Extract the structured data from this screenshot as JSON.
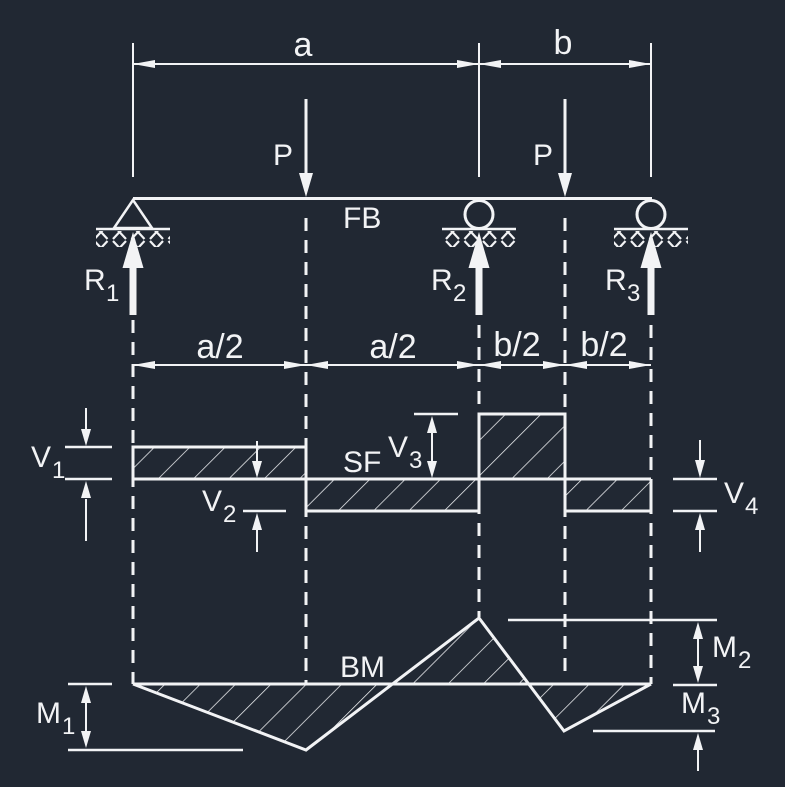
{
  "colors": {
    "background": "#212833",
    "stroke": "#f2f3f5"
  },
  "top_dims": {
    "a": "a",
    "b": "b"
  },
  "loads": {
    "p1": "P",
    "p2": "P"
  },
  "beam": {
    "label": "FB"
  },
  "reactions": {
    "r1": {
      "main": "R",
      "sub": "1"
    },
    "r2": {
      "main": "R",
      "sub": "2"
    },
    "r3": {
      "main": "R",
      "sub": "3"
    }
  },
  "half_dims": {
    "s1": "a/2",
    "s2": "a/2",
    "s3": "b/2",
    "s4": "b/2"
  },
  "shear": {
    "label": "SF",
    "v1": {
      "main": "V",
      "sub": "1"
    },
    "v2": {
      "main": "V",
      "sub": "2"
    },
    "v3": {
      "main": "V",
      "sub": "3"
    },
    "v4": {
      "main": "V",
      "sub": "4"
    }
  },
  "moment": {
    "label": "BM",
    "m1": {
      "main": "M",
      "sub": "1"
    },
    "m2": {
      "main": "M",
      "sub": "2"
    },
    "m3": {
      "main": "M",
      "sub": "3"
    }
  }
}
